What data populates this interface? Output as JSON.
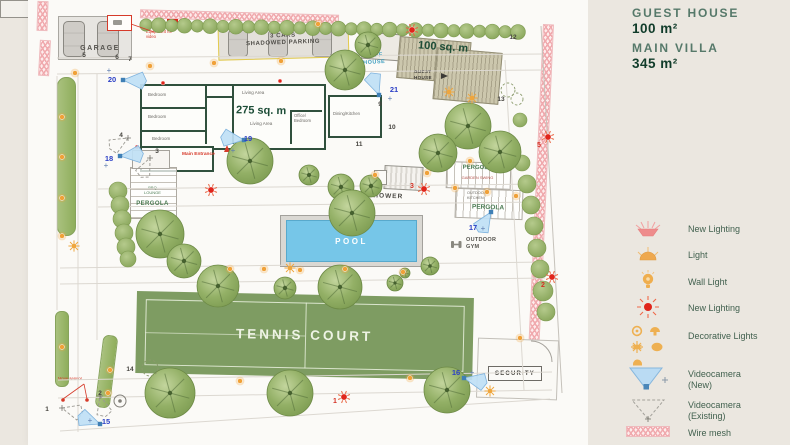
{
  "panel": {
    "guest_house_label": "GUEST HOUSE",
    "guest_house_area": "100 m²",
    "main_villa_label": "MAIN VILLA",
    "main_villa_area": "345 m²",
    "legend": [
      {
        "icon": "new-lighting-lamp-icon",
        "label": "New Lighting"
      },
      {
        "icon": "light-icon",
        "label": "Light"
      },
      {
        "icon": "wall-light-icon",
        "label": "Wall Light"
      },
      {
        "icon": "new-lighting-red-icon",
        "label": "New Lighting"
      },
      {
        "icon": "decorative-lights-icon",
        "label": "Decorative Lights"
      },
      {
        "icon": "videocamera-new-icon",
        "label": "Videocamera\n(New)"
      },
      {
        "icon": "videocamera-existing-icon",
        "label": "Videocamera\n(Existing)"
      },
      {
        "icon": "wire-mesh-icon",
        "label": "Wire mesh"
      }
    ]
  },
  "plan": {
    "labels": {
      "garage": "GARAGE",
      "parking": "3 CARS\nSHADOWED PARKING",
      "staff_house": "STAFF\nHOUSE",
      "guest_house": "GUEST\nHOUSE",
      "guest_house_area": "100 sq. m",
      "villa_area": "275 sq. m",
      "bedroom1": "Bedroom",
      "bedroom2": "Bedroom",
      "bedroom3": "Bedroom",
      "living_area1": "Living Area",
      "living_area2": "Living Area",
      "office_bedroom": "Office/\nBedroom",
      "dining_kitchen": "Dining/Kitchen",
      "main_entrance": "Main Entrance",
      "equipment": "Equipment for\nvideo",
      "pergola_bbq": "PERGOLA",
      "bbq_lounge": "BBQ\nLOUNGE",
      "pergola_swing": "PERGOLA",
      "garden_swing": "GARDEN SWING",
      "pergola_kitchen": "PERGOLA",
      "outdoor_kitchen": "OUTDOOR\nKITCHEN",
      "shower": "SHOWER",
      "pool": "POOL",
      "outdoor_gym": "OUTDOOR\nGYM",
      "tennis_court": "TENNIS COURT",
      "security": "SECURITY",
      "move_sensor": "Move sensor"
    },
    "hedge_row": {
      "x0": 146,
      "y0": 25,
      "x1": 518,
      "y1": 32,
      "count": 30
    },
    "trees": [
      [
        345,
        70,
        20
      ],
      [
        368,
        45,
        13
      ],
      [
        468,
        126,
        23
      ],
      [
        438,
        153,
        19
      ],
      [
        500,
        152,
        21
      ],
      [
        250,
        161,
        23
      ],
      [
        309,
        175,
        10
      ],
      [
        341,
        187,
        13
      ],
      [
        371,
        186,
        11
      ],
      [
        352,
        213,
        23
      ],
      [
        160,
        234,
        24
      ],
      [
        184,
        261,
        17
      ],
      [
        218,
        286,
        21
      ],
      [
        285,
        288,
        11
      ],
      [
        340,
        287,
        22
      ],
      [
        170,
        393,
        25
      ],
      [
        290,
        393,
        23
      ],
      [
        447,
        390,
        23
      ],
      [
        430,
        266,
        9
      ],
      [
        405,
        273,
        5
      ],
      [
        395,
        283,
        8
      ]
    ],
    "bushes": [
      [
        522,
        163,
        8
      ],
      [
        527,
        184,
        9
      ],
      [
        531,
        205,
        9
      ],
      [
        534,
        226,
        9
      ],
      [
        537,
        248,
        9
      ],
      [
        540,
        269,
        9
      ],
      [
        543,
        291,
        10
      ],
      [
        546,
        312,
        9
      ],
      [
        118,
        191,
        9
      ],
      [
        120,
        205,
        9
      ],
      [
        122,
        219,
        9
      ],
      [
        124,
        233,
        9
      ],
      [
        126,
        247,
        9
      ],
      [
        128,
        259,
        8
      ],
      [
        520,
        120,
        7
      ]
    ],
    "dashed_bushes": [
      [
        508,
        90,
        7
      ],
      [
        517,
        99,
        6
      ],
      [
        150,
        368,
        8
      ]
    ],
    "dots": [
      [
        75,
        73
      ],
      [
        62,
        117
      ],
      [
        62,
        157
      ],
      [
        62,
        198
      ],
      [
        62,
        236
      ],
      [
        150,
        66
      ],
      [
        214,
        63
      ],
      [
        281,
        61
      ],
      [
        318,
        24
      ],
      [
        375,
        175
      ],
      [
        427,
        173
      ],
      [
        455,
        188
      ],
      [
        487,
        192
      ],
      [
        516,
        196
      ],
      [
        470,
        161
      ],
      [
        230,
        269
      ],
      [
        264,
        269
      ],
      [
        300,
        270
      ],
      [
        345,
        269
      ],
      [
        403,
        272
      ],
      [
        110,
        370
      ],
      [
        108,
        393
      ],
      [
        62,
        347
      ],
      [
        240,
        381
      ],
      [
        410,
        378
      ],
      [
        520,
        338
      ]
    ],
    "sunbursts": [
      [
        449,
        92
      ],
      [
        472,
        98
      ],
      [
        290,
        268
      ],
      [
        74,
        246
      ],
      [
        490,
        391
      ]
    ],
    "red_lights": [
      {
        "x": 424,
        "y": 189,
        "n": "3",
        "nx": 412,
        "ny": 188
      },
      {
        "x": 548,
        "y": 137,
        "n": "5",
        "nx": 539,
        "ny": 147
      },
      {
        "x": 552,
        "y": 277,
        "n": "2",
        "nx": 543,
        "ny": 287
      },
      {
        "x": 344,
        "y": 397,
        "n": "1",
        "nx": 335,
        "ny": 403
      },
      {
        "x": 211,
        "y": 190
      },
      {
        "x": 412,
        "y": 30
      },
      {
        "x": 163,
        "y": 83,
        "small": true
      },
      {
        "x": 280,
        "y": 81,
        "small": true
      },
      {
        "x": 137,
        "y": 147,
        "small": true
      }
    ],
    "blue_cameras": [
      {
        "n": "15",
        "x": 100,
        "y": 424,
        "dir": -160,
        "nx": 106,
        "ny": 424,
        "px": 90,
        "py": 423
      },
      {
        "n": "16",
        "x": 464,
        "y": 378,
        "dir": 12,
        "nx": 456,
        "ny": 375,
        "px": 472,
        "py": 375
      },
      {
        "n": "17",
        "x": 491,
        "y": 212,
        "dir": 122,
        "nx": 473,
        "ny": 230,
        "px": 483,
        "py": 231
      },
      {
        "n": "18",
        "x": 120,
        "y": 156,
        "dir": -6,
        "nx": 109,
        "ny": 161,
        "px": 106,
        "py": 168
      },
      {
        "n": "19",
        "x": 244,
        "y": 140,
        "dir": 187,
        "nx": 248,
        "ny": 141,
        "px": 233,
        "py": 153
      },
      {
        "n": "20",
        "x": 123,
        "y": 80,
        "dir": 2,
        "nx": 112,
        "ny": 82,
        "px": 109,
        "py": 73
      },
      {
        "n": "21",
        "x": 379,
        "y": 95,
        "dir": -110,
        "nx": 394,
        "ny": 92,
        "px": 390,
        "py": 101
      }
    ],
    "existing_cameras": [
      [
        128,
        138,
        150
      ],
      [
        150,
        158,
        115
      ],
      [
        62,
        408,
        15
      ],
      [
        100,
        396,
        75
      ]
    ],
    "black_numbers": [
      {
        "n": "1",
        "x": 47,
        "y": 411
      },
      {
        "n": "2",
        "x": 100,
        "y": 395
      },
      {
        "n": "3",
        "x": 157,
        "y": 153
      },
      {
        "n": "4",
        "x": 121,
        "y": 137
      },
      {
        "n": "5",
        "x": 84,
        "y": 57
      },
      {
        "n": "6",
        "x": 117,
        "y": 59
      },
      {
        "n": "7",
        "x": 130,
        "y": 61
      },
      {
        "n": "9",
        "x": 380,
        "y": 106
      },
      {
        "n": "10",
        "x": 392,
        "y": 129
      },
      {
        "n": "11",
        "x": 359,
        "y": 146
      },
      {
        "n": "12",
        "x": 513,
        "y": 39
      },
      {
        "n": "13",
        "x": 501,
        "y": 101
      },
      {
        "n": "14",
        "x": 130,
        "y": 371
      }
    ],
    "path_edges": [
      [
        57,
        58,
        543,
        54
      ],
      [
        57,
        74,
        543,
        70
      ],
      [
        78,
        74,
        78,
        432
      ],
      [
        97,
        74,
        97,
        340
      ],
      [
        98,
        189,
        540,
        184
      ],
      [
        98,
        207,
        540,
        202
      ],
      [
        60,
        268,
        545,
        262
      ],
      [
        60,
        284,
        545,
        278
      ],
      [
        58,
        380,
        552,
        372
      ],
      [
        58,
        398,
        552,
        390
      ],
      [
        505,
        60,
        524,
        390
      ],
      [
        60,
        431,
        550,
        399
      ],
      [
        57,
        76,
        57,
        310
      ]
    ],
    "boundary": [
      541,
      26,
      562,
      393
    ],
    "door_arc": [
      531,
      341,
      21
    ],
    "target": [
      120,
      401
    ],
    "red_leaders": [
      [
        154,
        32,
        131,
        24
      ],
      [
        84,
        384,
        63,
        399
      ],
      [
        84,
        384,
        87,
        399
      ]
    ],
    "sensor_dots": [
      [
        63,
        400
      ],
      [
        87,
        400
      ]
    ],
    "gym_icon": [
      452,
      240
    ]
  },
  "colors": {
    "accent_green": "#1d4d37",
    "red": "#e0251b",
    "blue": "#2b3fc6",
    "orange": "#f0a138",
    "teal": "#3f9fc0",
    "camera_fill": "#bfe0f5",
    "mesh_pink": "#f0a9ad",
    "tree_green": "#8fae5c",
    "tennis_green": "#7e9c62",
    "pool_blue": "#76c6e8"
  }
}
